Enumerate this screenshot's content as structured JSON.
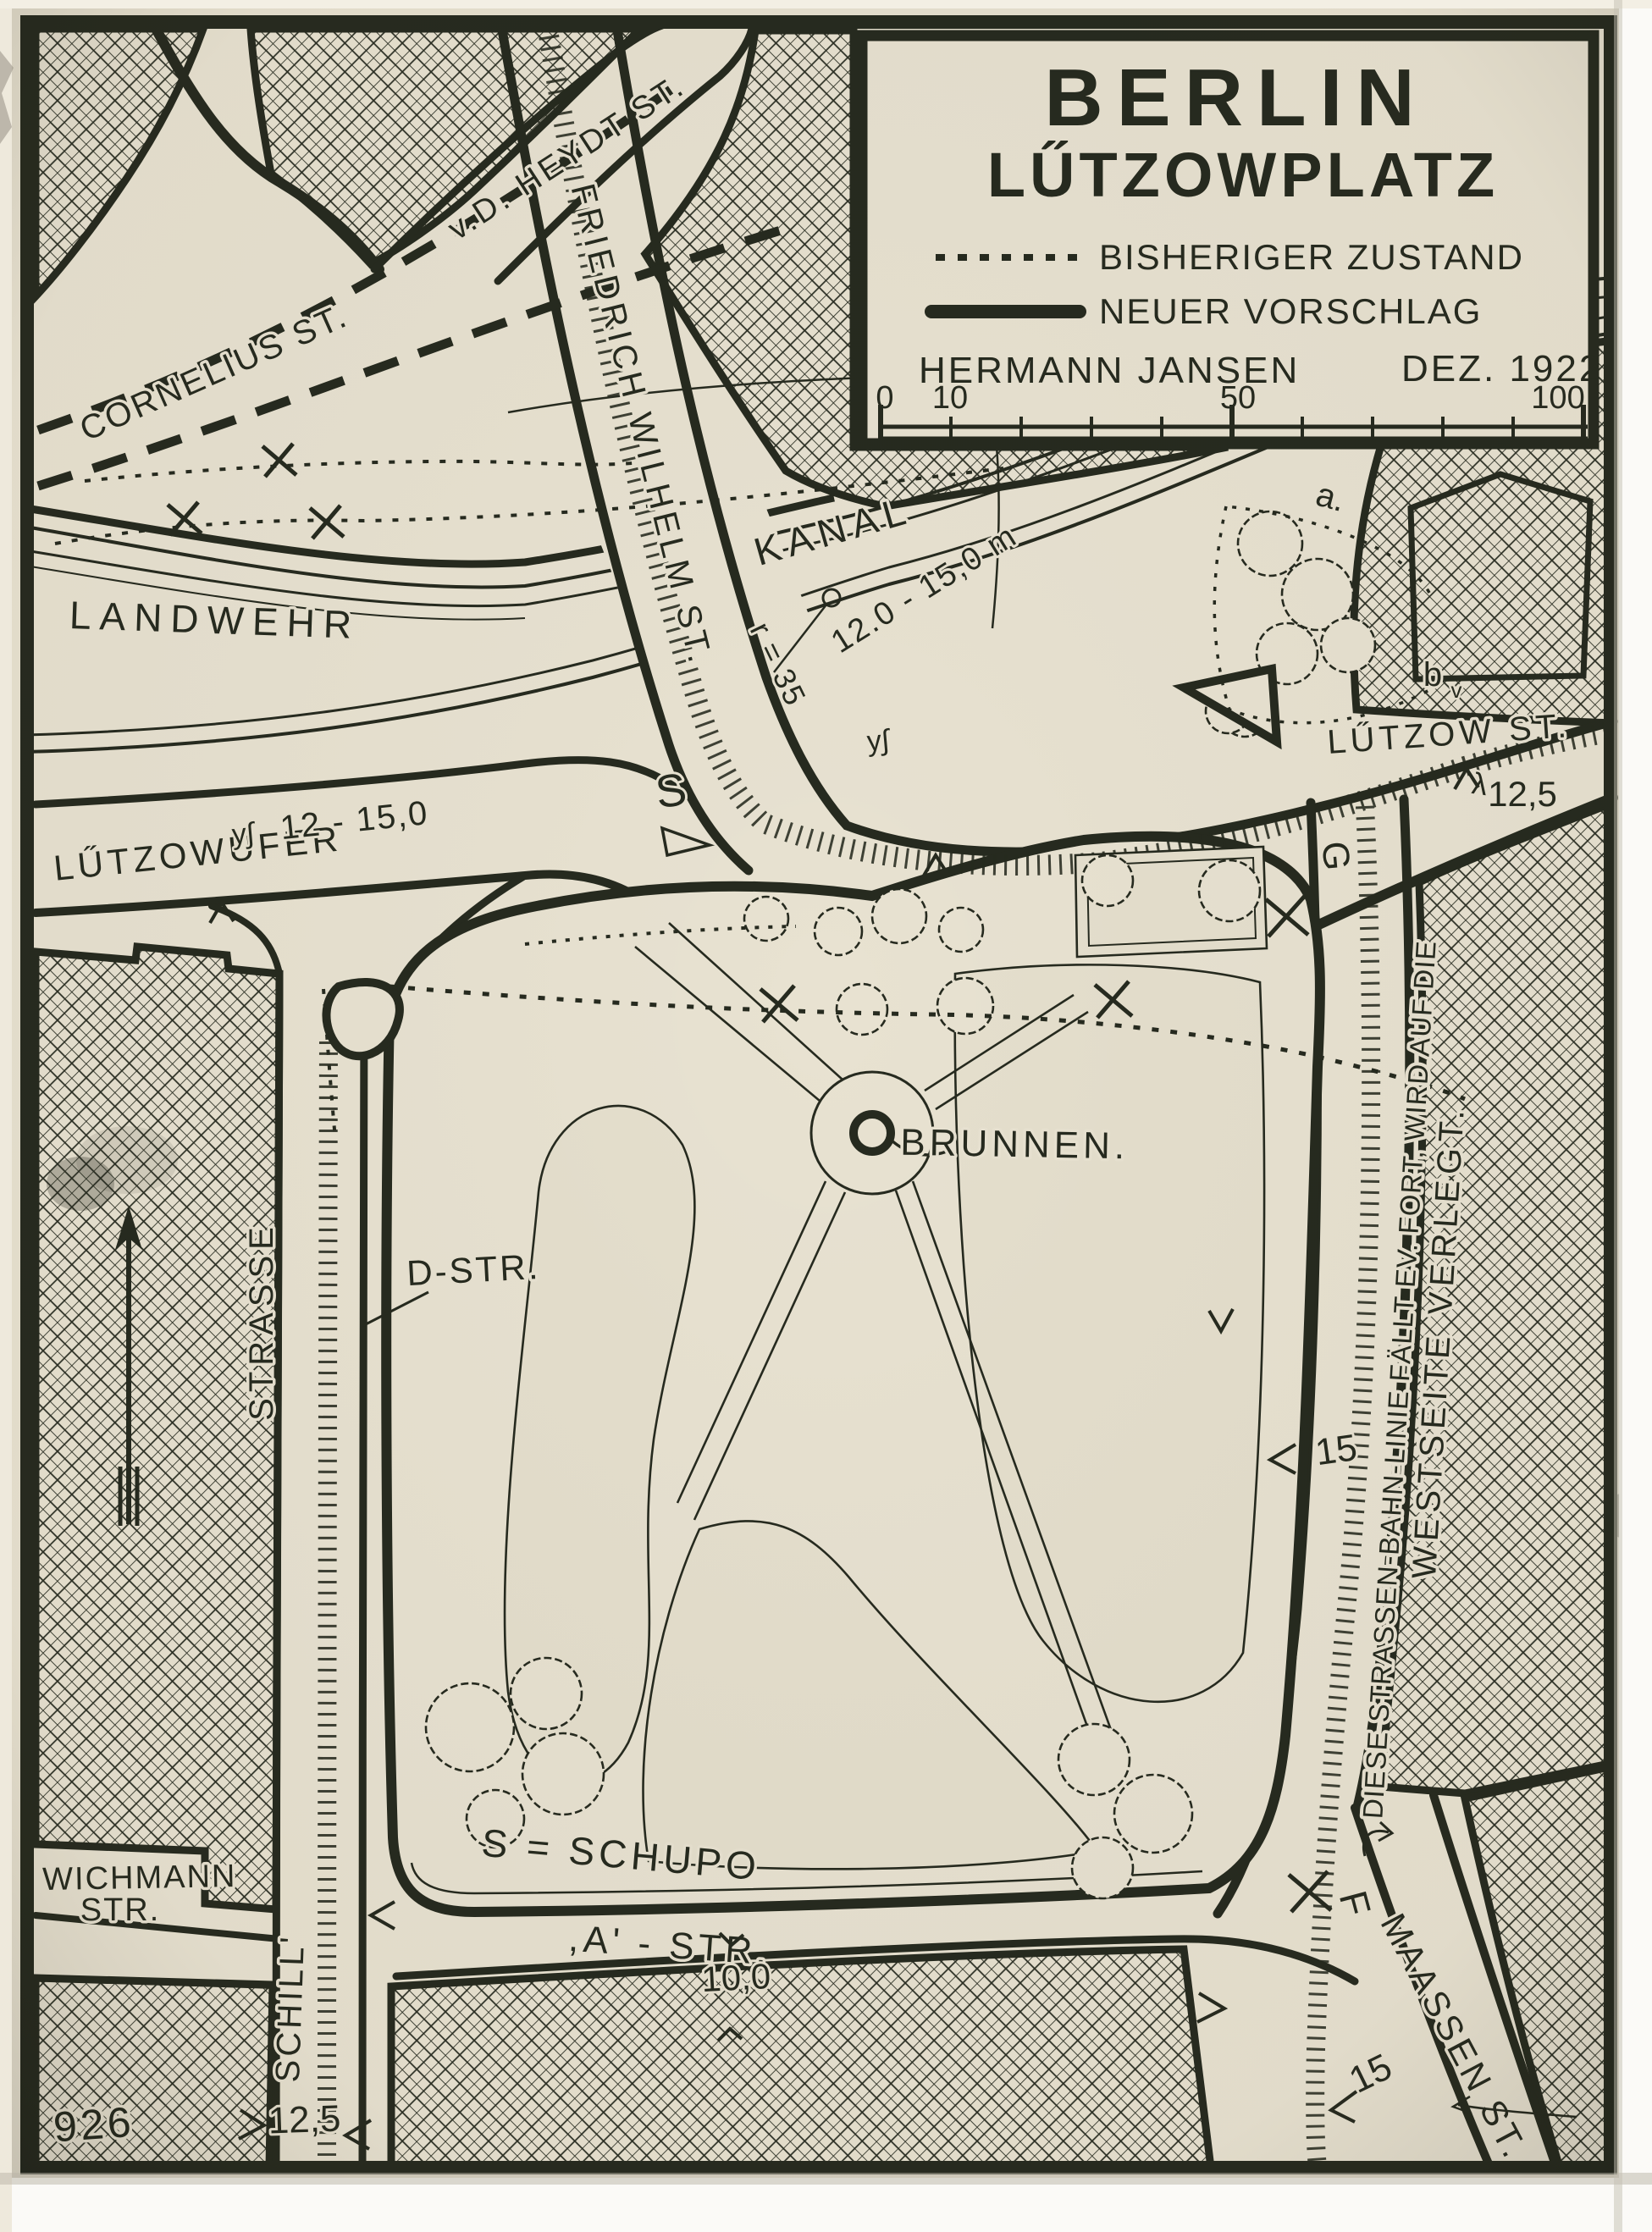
{
  "colors": {
    "paper": "#e8e2d1",
    "ink": "#262a1f",
    "paper_edge": "#fbfaf7"
  },
  "title_block": {
    "title_line1": "BERLIN",
    "title_line2": "LŰTZOWPLATZ",
    "legend": [
      {
        "line_style": "dashed",
        "label": "BISHERIGER ZUSTAND"
      },
      {
        "line_style": "solid",
        "label": "NEUER VORSCHLAG"
      }
    ],
    "author": "HERMANN JANSEN",
    "date": "DEZ. 1922",
    "scale_bar": {
      "ticks": [
        "0",
        "10",
        "50",
        "100"
      ]
    }
  },
  "streets": {
    "cornelius": "CORNELIUS ST.",
    "vd_heydt": "v.D. HEYDT ST.",
    "friedrich_wilhelm": "FRIEDRICH WILHELM ST.",
    "landwehr": "LANDWEHR",
    "kanal": "KANAL",
    "luetzowufer": "LŰTZOWUFER",
    "luetzow": "LŰTZOW ST.",
    "schill_upper": "STRASSE",
    "schill_lower": "SCHILL'",
    "wichmann_line1": "WICHMANN",
    "wichmann_line2": "STR.",
    "a_strasse": ",A' - STR.",
    "maassen": "MAASSEN ST.",
    "d_strasse": "D-STR."
  },
  "labels": {
    "brunnen": "BRUNNEN.",
    "schupo": "S = SCHUPO",
    "schupo_marker": "S",
    "radius": "r = 35",
    "canal_width": "12.0 - 15,0 m",
    "ufer_width": "12 - 15,0",
    "luetzow_width": "12,5",
    "schill_width": "12,5",
    "a_width": "10,0",
    "east_width_upper": "15",
    "east_width_lower": "15",
    "point_a": "a.",
    "point_b": "b",
    "point_b_sub": "v",
    "point_f": "F",
    "point_g": "G",
    "plan_number": "926",
    "mark_canal": "y∫",
    "mark_ufer": "y∫",
    "mark_luetzow": "λ"
  },
  "notes": {
    "tram_note_line1": "DIESE STRASSEN-BAHN-LINIE FÄLLT EV. FORT, WIRD AUF DIE",
    "tram_note_line2": "WESTSEITE  VERLEGT."
  }
}
